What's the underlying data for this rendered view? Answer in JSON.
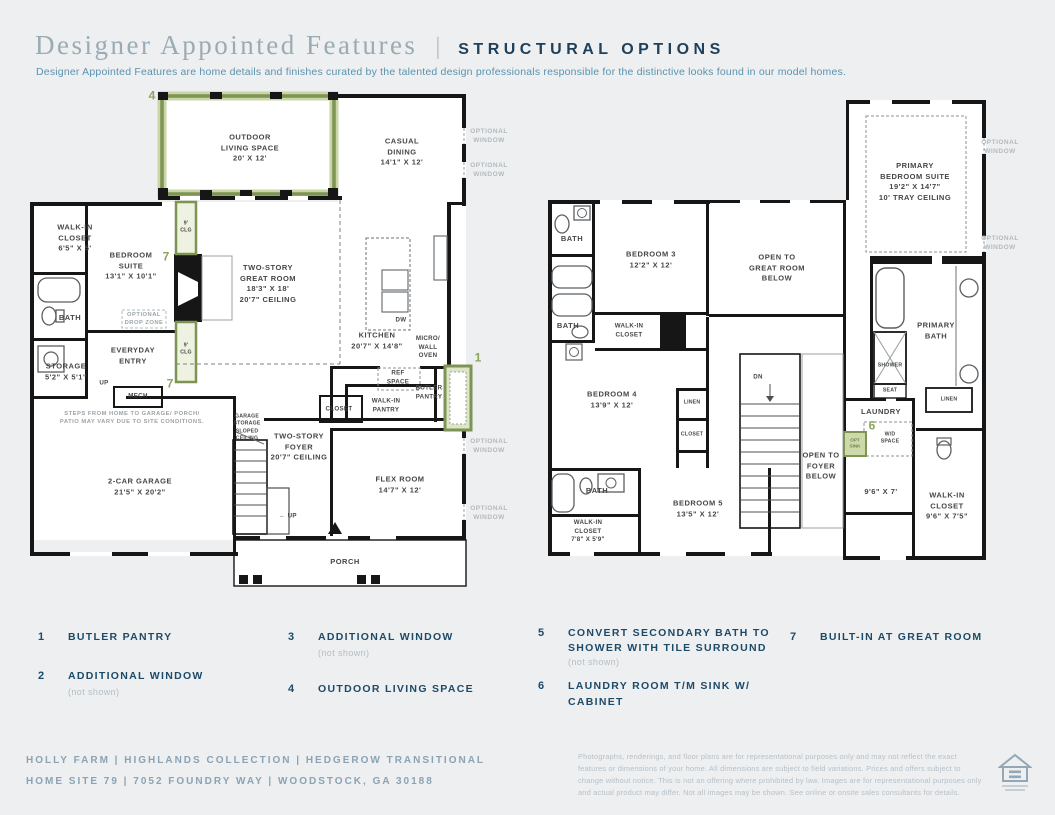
{
  "header": {
    "title_serif": "Designer Appointed Features",
    "divider": "|",
    "title_caps": "STRUCTURAL OPTIONS",
    "subtitle": "Designer Appointed Features are home details and finishes curated by the talented design professionals responsible for the distinctive looks found in our model homes."
  },
  "shared": {
    "optional_window": "OPTIONAL\nWINDOW"
  },
  "floor1": {
    "labels": {
      "outdoor_living": "OUTDOOR\nLIVING SPACE\n20' X 12'",
      "casual_dining": "CASUAL\nDINING\n14'1\" X 12'",
      "walk_in_closet": "WALK-IN\nCLOSET\n6'5\" X 5'",
      "bedroom_suite": "BEDROOM\nSUITE\n13'1\" X 10'1\"",
      "nine_clg": "9'\nCLG",
      "great_room": "TWO-STORY\nGREAT ROOM\n18'3\" X 18'\n20'7\" CEILING",
      "bath": "BATH",
      "drop_zone": "OPTIONAL\nDROP ZONE",
      "everyday_entry": "EVERYDAY\nENTRY",
      "storage": "STORAGE\n5'2\" X 5'1\"",
      "up": "UP",
      "up_arrow": "← UP",
      "mech": "MECH",
      "kitchen": "KITCHEN\n20'7\" X 14'8\"",
      "dw": "DW",
      "micro_wall_oven": "MICRO/\nWALL\nOVEN",
      "ref_space": "REF\nSPACE",
      "butler_pantry": "BUTLER\nPANTRY",
      "closet": "CLOSET",
      "walk_in_pantry": "WALK-IN\nPANTRY",
      "steps_note": "STEPS FROM HOME TO GARAGE/ PORCH/\nPATIO MAY VARY DUE TO SITE CONDITIONS.",
      "garage_storage": "GARAGE\nSTORAGE\nSLOPED\nCEILING",
      "foyer": "TWO-STORY\nFOYER\n20'7\" CEILING",
      "garage": "2-CAR GARAGE\n21'5\" X 20'2\"",
      "flex_room": "FLEX ROOM\n14'7\" X 12'",
      "porch": "PORCH"
    }
  },
  "floor2": {
    "labels": {
      "primary_suite": "PRIMARY\nBEDROOM SUITE\n19'2\" X 14'7\"\n10' TRAY CEILING",
      "bath": "BATH",
      "bedroom3": "BEDROOM 3\n12'2\" X 12'",
      "open_great_room": "OPEN TO\nGREAT ROOM\nBELOW",
      "walk_in_closet": "WALK-IN\nCLOSET",
      "bedroom4": "BEDROOM 4\n13'9\" X 12'",
      "linen": "LINEN",
      "closet": "CLOSET",
      "dn": "DN",
      "open_foyer": "OPEN TO\nFOYER\nBELOW",
      "bedroom5": "BEDROOM 5\n13'5\" X 12'",
      "wic_small": "WALK-IN\nCLOSET\n7'8\" X 5'9\"",
      "primary_bath": "PRIMARY\nBATH",
      "shower": "SHOWER",
      "seat": "SEAT",
      "laundry": "LAUNDRY",
      "wd_space": "W/D\nSPACE",
      "opt_sink": "OPT\nSINK",
      "laundry_dims": "9'6\" X 7'",
      "wic_primary": "WALK-IN\nCLOSET\n9'6\" X 7'5\""
    }
  },
  "options": [
    {
      "num": "1",
      "label": "BUTLER PANTRY",
      "note": ""
    },
    {
      "num": "2",
      "label": "ADDITIONAL WINDOW",
      "note": "(not shown)"
    },
    {
      "num": "3",
      "label": "ADDITIONAL WINDOW",
      "note": "(not shown)"
    },
    {
      "num": "4",
      "label": "OUTDOOR LIVING SPACE",
      "note": ""
    },
    {
      "num": "5",
      "label": "CONVERT SECONDARY BATH TO SHOWER WITH TILE SURROUND",
      "note": "(not shown)"
    },
    {
      "num": "6",
      "label": "LAUNDRY ROOM T/M SINK W/ CABINET",
      "note": ""
    },
    {
      "num": "7",
      "label": "BUILT-IN AT GREAT ROOM",
      "note": ""
    }
  ],
  "footer": {
    "line1": "HOLLY FARM  |  HIGHLANDS COLLECTION  |  HEDGEROW TRANSITIONAL",
    "line2": "HOME SITE 79  |  7052 FOUNDRY WAY  |  WOODSTOCK, GA 30188",
    "disclaimer": "Photographs, renderings, and floor plans are for representational purposes only and may not reflect the exact features or dimensions of your home. All dimensions are subject to field variations. Prices and offers subject to change without notice. This is not an offering where prohibited by law. Images are for representational purposes only and actual product may differ. Not all images may be shown. See online or onsite sales consultants for details.",
    "logo_name": "equal-housing-opportunity"
  },
  "colors": {
    "accent_green": "#7d9455",
    "accent_green_fill": "#dce5c5",
    "navy": "#1d4a68",
    "wall_black": "#161616",
    "page_bg": "#edeff0"
  }
}
